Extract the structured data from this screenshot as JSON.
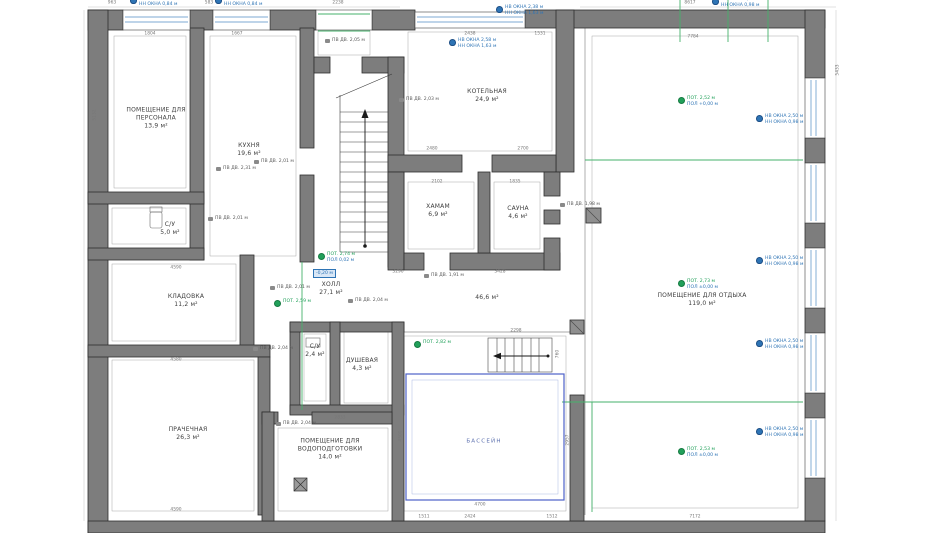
{
  "rooms": [
    {
      "name": "ПОМЕЩЕНИЕ ДЛЯ\nПЕРСОНАЛА",
      "area": "13,9 м²",
      "x": 156,
      "y": 118
    },
    {
      "name": "КУХНЯ",
      "area": "19,6 м²",
      "x": 249,
      "y": 150
    },
    {
      "name": "КОТЕЛЬНАЯ",
      "area": "24,9 м²",
      "x": 487,
      "y": 96
    },
    {
      "name": "ХАМАМ",
      "area": "6,9 м²",
      "x": 438,
      "y": 211
    },
    {
      "name": "САУНА",
      "area": "4,6 м²",
      "x": 518,
      "y": 213
    },
    {
      "name": "С/У",
      "area": "5,0 м²",
      "x": 170,
      "y": 229
    },
    {
      "name": "ХОЛЛ",
      "area": "27,1 м²",
      "x": 331,
      "y": 289
    },
    {
      "name": "",
      "area": "46,6 м²",
      "x": 487,
      "y": 298
    },
    {
      "name": "КЛАДОВКА",
      "area": "11,2 м²",
      "x": 186,
      "y": 301
    },
    {
      "name": "ПРАЧЕЧНАЯ",
      "area": "26,3 м²",
      "x": 188,
      "y": 434
    },
    {
      "name": "С/У",
      "area": "2,4 м²",
      "x": 315,
      "y": 351
    },
    {
      "name": "ДУШЕВАЯ",
      "area": "4,3 м²",
      "x": 362,
      "y": 365
    },
    {
      "name": "ПОМЕЩЕНИЕ ДЛЯ\nВОДОПОДГОТОВКИ",
      "area": "14,0 м²",
      "x": 330,
      "y": 449
    },
    {
      "name": "ПОМЕЩЕНИЕ ДЛЯ ОТДЫХА",
      "area": "119,0 м²",
      "x": 702,
      "y": 300
    },
    {
      "name": "БАССЕЙН",
      "area": "",
      "x": 484,
      "y": 442,
      "cls": "pool"
    }
  ],
  "annotations": [
    {
      "kind": "window",
      "x": 130,
      "y": -4,
      "lines": [
        "НВ ОКНА 1,84 м",
        "НН ОКНА 0,84 м"
      ]
    },
    {
      "kind": "window",
      "x": 215,
      "y": -4,
      "lines": [
        "НВ ОКНА 1,84 м",
        "НН ОКНА 0,84 м"
      ]
    },
    {
      "kind": "window",
      "x": 449,
      "y": 38,
      "lines": [
        "НВ ОКНА 2,58 м",
        "НН ОКНА 1,63 м"
      ]
    },
    {
      "kind": "window",
      "x": 496,
      "y": 5,
      "lines": [
        "НВ ОКНА 2,38 м",
        "НН ОКНА 1,63 м"
      ]
    },
    {
      "kind": "window",
      "x": 712,
      "y": -3,
      "lines": [
        "НВ ОКНА 2,50 м",
        "НН ОКНА 0,98 м"
      ]
    },
    {
      "kind": "window",
      "x": 756,
      "y": 114,
      "lines": [
        "НВ ОКНА 2,50 м",
        "НН ОКНА 0,98 м"
      ]
    },
    {
      "kind": "window",
      "x": 756,
      "y": 256,
      "lines": [
        "НВ ОКНА 2,50 м",
        "НН ОКНА 0,98 м"
      ]
    },
    {
      "kind": "window",
      "x": 756,
      "y": 339,
      "lines": [
        "НВ ОКНА 2,50 м",
        "НН ОКНА 0,98 м"
      ]
    },
    {
      "kind": "window",
      "x": 756,
      "y": 427,
      "lines": [
        "НВ ОКНА 2,50 м",
        "НН ОКНА 0,98 м"
      ]
    },
    {
      "kind": "ceiling",
      "x": 678,
      "y": 96,
      "lines": [
        "ПОТ. 2,52 м",
        "ПОЛ +0,00 м"
      ]
    },
    {
      "kind": "ceiling",
      "x": 678,
      "y": 279,
      "lines": [
        "ПОТ. 2,73 м",
        "ПОЛ ±0,00 м"
      ]
    },
    {
      "kind": "ceiling",
      "x": 678,
      "y": 447,
      "lines": [
        "ПОТ. 2,53 м",
        "ПОЛ ±0,00 м"
      ]
    },
    {
      "kind": "ceiling",
      "x": 414,
      "y": 340,
      "lines": [
        "ПОТ. 2,82 м"
      ]
    },
    {
      "kind": "ceiling",
      "x": 318,
      "y": 252,
      "lines": [
        "ПОТ. 2,74 м",
        "ПОЛ 0,02 м"
      ]
    },
    {
      "kind": "ceiling",
      "x": 274,
      "y": 299,
      "lines": [
        "ПОТ. 2,59 м"
      ]
    },
    {
      "kind": "door",
      "x": 325,
      "y": 38,
      "lines": [
        "ПВ ДВ. 2,05 м"
      ]
    },
    {
      "kind": "door",
      "x": 399,
      "y": 97,
      "lines": [
        "ПВ ДВ. 2,03 м"
      ]
    },
    {
      "kind": "door",
      "x": 216,
      "y": 166,
      "lines": [
        "ПВ ДВ. 2,31 м"
      ]
    },
    {
      "kind": "door",
      "x": 254,
      "y": 159,
      "lines": [
        "ПВ ДВ. 2,01 м"
      ]
    },
    {
      "kind": "door",
      "x": 208,
      "y": 216,
      "lines": [
        "ПВ ДВ. 2,01 м"
      ]
    },
    {
      "kind": "door",
      "x": 270,
      "y": 285,
      "lines": [
        "ПВ ДВ. 2,01 м"
      ]
    },
    {
      "kind": "door",
      "x": 348,
      "y": 298,
      "lines": [
        "ПВ ДВ. 2,04 м"
      ]
    },
    {
      "kind": "door",
      "x": 253,
      "y": 346,
      "lines": [
        "ПВ ДВ. 2,04 м"
      ]
    },
    {
      "kind": "door",
      "x": 276,
      "y": 421,
      "lines": [
        "ПВ ДВ. 2,04 м"
      ]
    },
    {
      "kind": "door",
      "x": 424,
      "y": 273,
      "lines": [
        "ПВ ДВ. 1,91 м"
      ]
    },
    {
      "kind": "door",
      "x": 560,
      "y": 202,
      "lines": [
        "ПВ ДВ. 1,98 м"
      ]
    }
  ],
  "level_box": {
    "text": "-0,20 м",
    "x": 313,
    "y": 269
  },
  "dims": [
    {
      "t": "963",
      "x": 112,
      "y": 3
    },
    {
      "t": "583",
      "x": 209,
      "y": 3
    },
    {
      "t": "2238",
      "x": 338,
      "y": 3
    },
    {
      "t": "8617",
      "x": 690,
      "y": 3
    },
    {
      "t": "7784",
      "x": 693,
      "y": 37
    },
    {
      "t": "1804",
      "x": 150,
      "y": 34
    },
    {
      "t": "1667",
      "x": 237,
      "y": 34
    },
    {
      "t": "2438",
      "x": 470,
      "y": 34
    },
    {
      "t": "1531",
      "x": 540,
      "y": 34
    },
    {
      "t": "2480",
      "x": 432,
      "y": 149
    },
    {
      "t": "2700",
      "x": 523,
      "y": 149
    },
    {
      "t": "2102",
      "x": 437,
      "y": 182
    },
    {
      "t": "1835",
      "x": 515,
      "y": 182
    },
    {
      "t": "3296",
      "x": 398,
      "y": 272
    },
    {
      "t": "3428",
      "x": 500,
      "y": 272
    },
    {
      "t": "5132",
      "x": 95,
      "y": 115,
      "rot": 1
    },
    {
      "t": "5433",
      "x": 838,
      "y": 70,
      "rot": 1
    },
    {
      "t": "4590",
      "x": 176,
      "y": 268
    },
    {
      "t": "4580",
      "x": 176,
      "y": 360
    },
    {
      "t": "4590",
      "x": 176,
      "y": 510
    },
    {
      "t": "2833",
      "x": 340,
      "y": 418
    },
    {
      "t": "2298",
      "x": 516,
      "y": 331
    },
    {
      "t": "760",
      "x": 558,
      "y": 354,
      "rot": 1
    },
    {
      "t": "4500",
      "x": 401,
      "y": 436,
      "rot": 1
    },
    {
      "t": "2957",
      "x": 568,
      "y": 440,
      "rot": 1
    },
    {
      "t": "4700",
      "x": 480,
      "y": 505
    },
    {
      "t": "1511",
      "x": 424,
      "y": 517
    },
    {
      "t": "2424",
      "x": 470,
      "y": 517
    },
    {
      "t": "1512",
      "x": 552,
      "y": 517
    },
    {
      "t": "7172",
      "x": 695,
      "y": 517
    }
  ],
  "colors": {
    "wall": "#7d7d7d",
    "wall_edge": "#2e2e2e",
    "glass": "#a8c6e2",
    "pool": "#4d61c9",
    "zone_green": "#45b26b",
    "annotation_blue": "#2e74b5",
    "annotation_green": "#21a05a"
  }
}
